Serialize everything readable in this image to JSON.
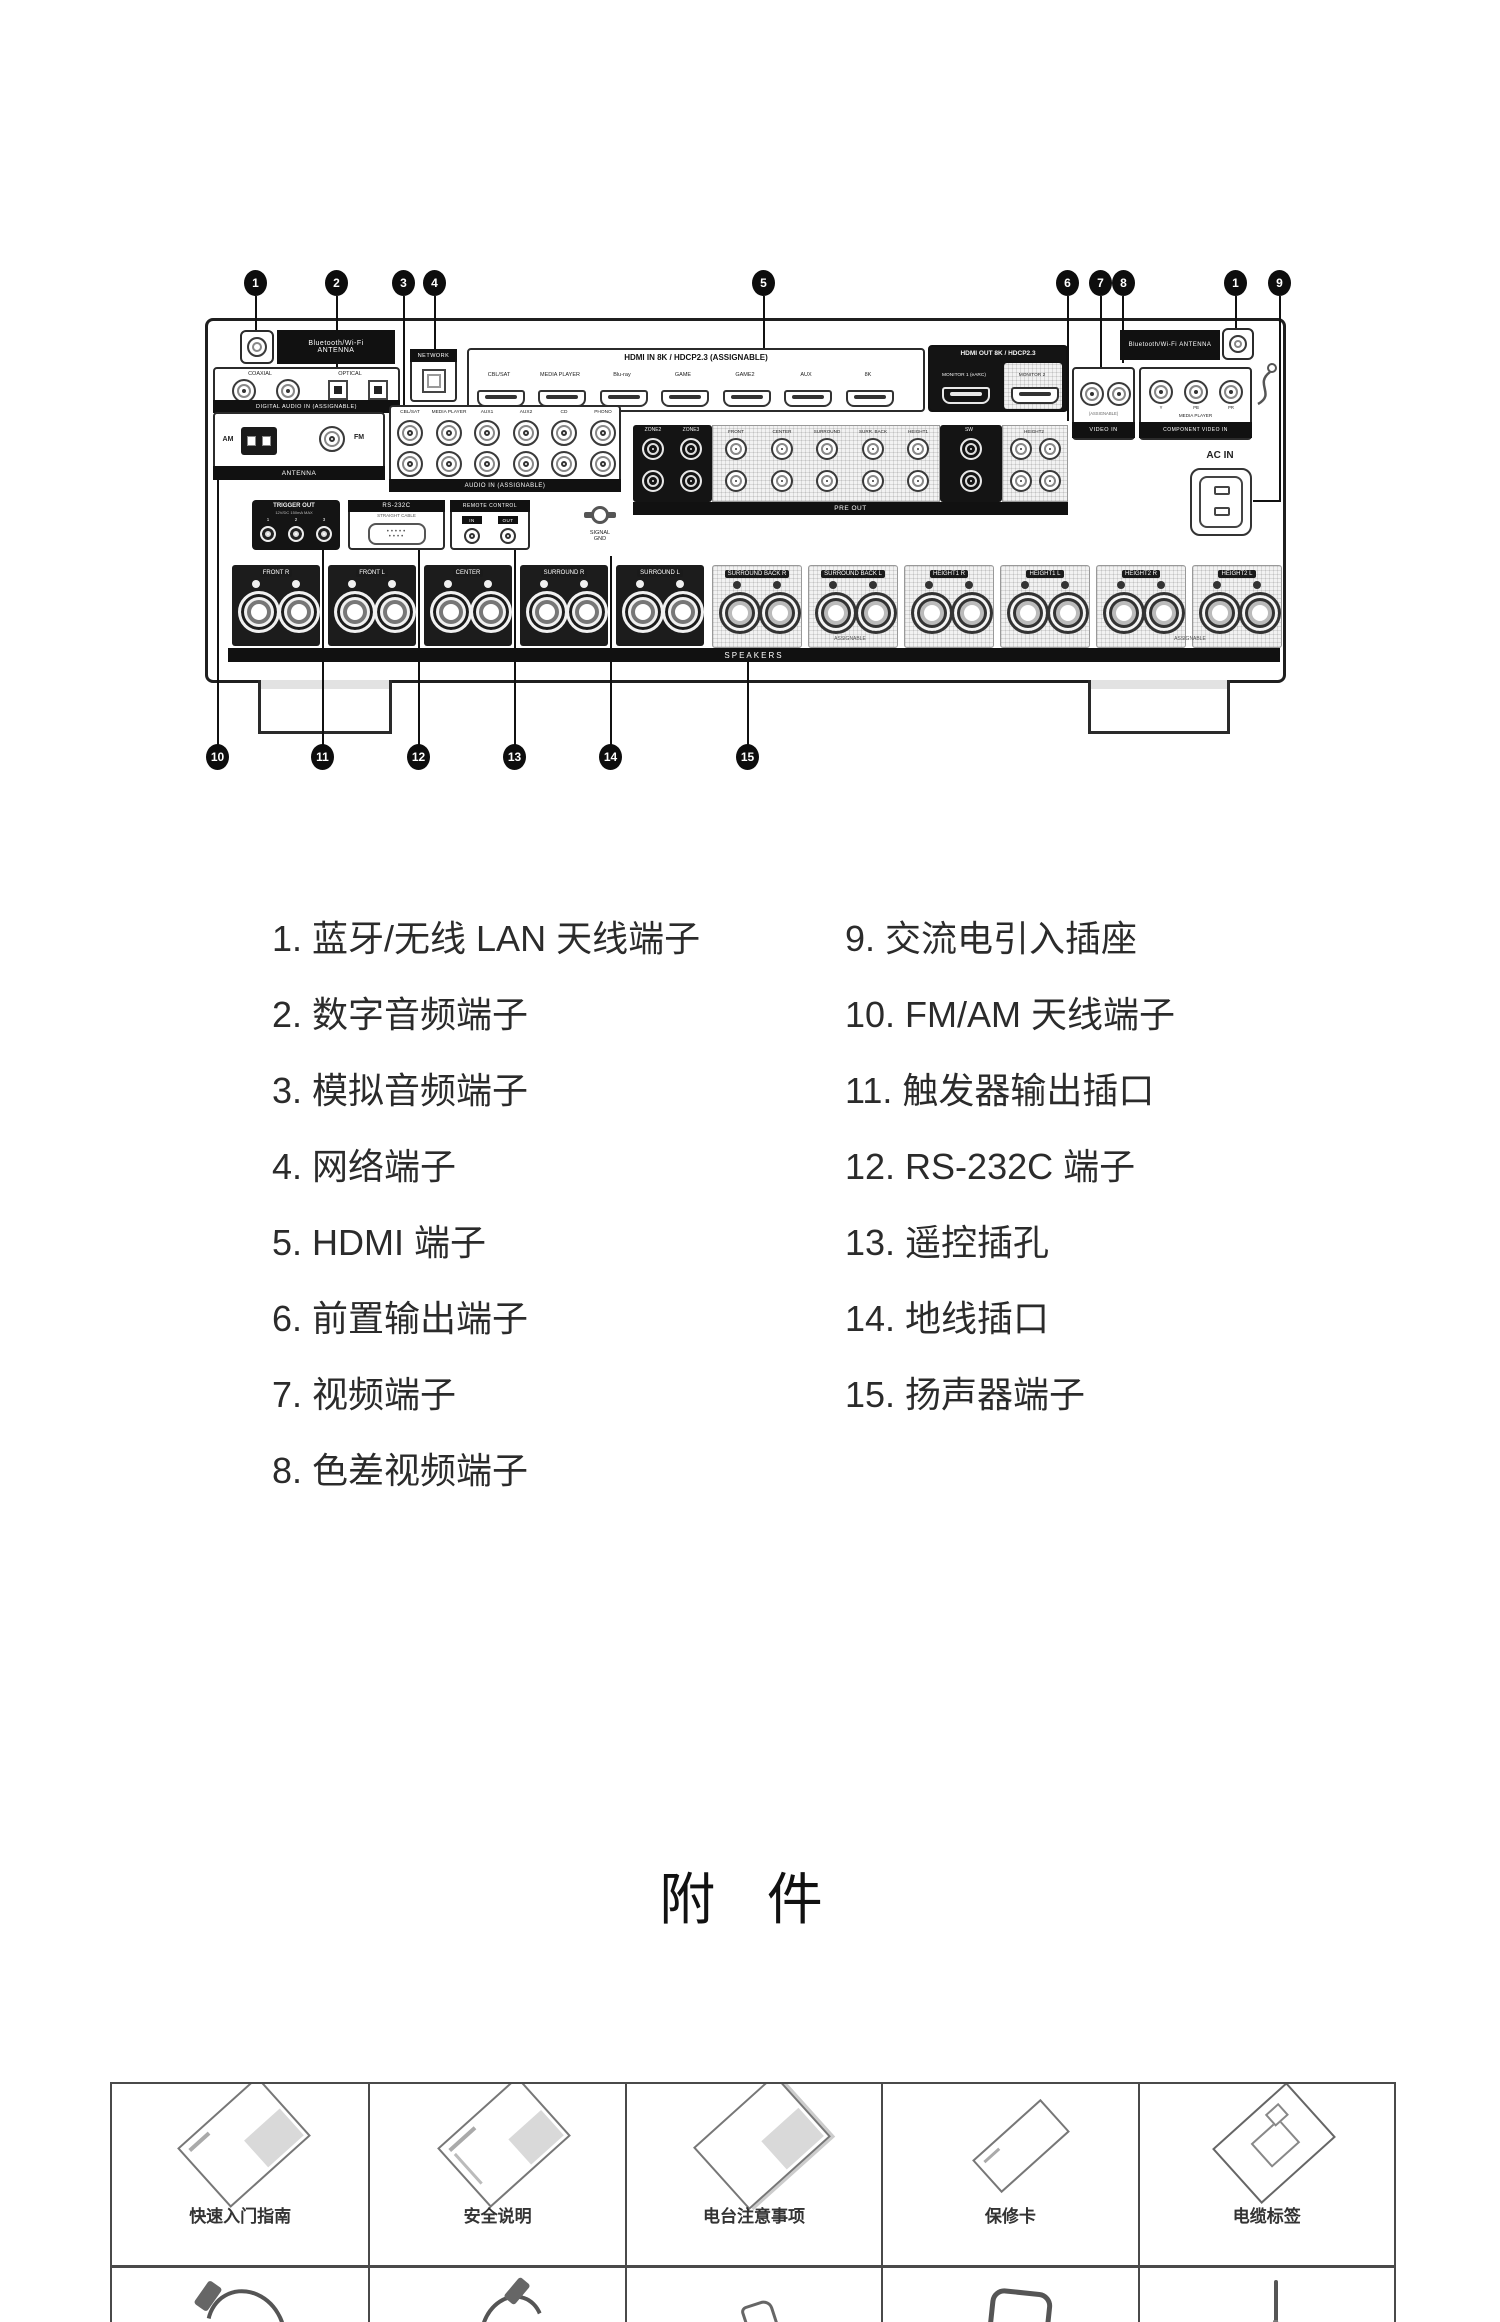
{
  "diagram": {
    "callouts_top": [
      {
        "n": "1"
      },
      {
        "n": "2"
      },
      {
        "n": "3"
      },
      {
        "n": "4"
      },
      {
        "n": "5"
      },
      {
        "n": "6"
      },
      {
        "n": "7"
      },
      {
        "n": "8"
      },
      {
        "n": "1"
      },
      {
        "n": "9"
      }
    ],
    "callouts_bottom": [
      {
        "n": "10"
      },
      {
        "n": "11"
      },
      {
        "n": "12"
      },
      {
        "n": "13"
      },
      {
        "n": "14"
      },
      {
        "n": "15"
      }
    ],
    "panel_labels": {
      "bt_antenna_line1": "Bluetooth/Wi-Fi",
      "bt_antenna_line2": "ANTENNA",
      "digital_audio_coaxial": "COAXIAL",
      "digital_audio_optical": "OPTICAL",
      "digital_audio_strip": "DIGITAL AUDIO IN (ASSIGNABLE)",
      "network": "NETWORK",
      "hdmi_in_header": "HDMI IN   8K / HDCP2.3  (ASSIGNABLE)",
      "hdmi_out_header": "HDMI OUT  8K / HDCP2.3",
      "hdmi_out_monitor1": "MONITOR 1 (eARC)",
      "hdmi_out_monitor2": "MONITOR 2",
      "hdmi_inputs": [
        "CBL/SAT",
        "MEDIA PLAYER",
        "Blu-ray",
        "GAME",
        "GAME2",
        "AUX",
        "8K"
      ],
      "antenna_am": "AM",
      "antenna_fm": "FM",
      "antenna_strip": "ANTENNA",
      "audio_columns": [
        "CBL/SAT",
        "MEDIA PLAYER",
        "AUX1",
        "AUX2",
        "CD",
        "PHONO"
      ],
      "audio_strip": "AUDIO IN (ASSIGNABLE)",
      "preout_zone2": "ZONE2",
      "preout_zone3": "ZONE3",
      "preout_columns": [
        "FRONT",
        "CENTER",
        "SURROUND",
        "SURR. BACK",
        "HEIGHT1"
      ],
      "preout_sw": "SW",
      "preout_height2": "HEIGHT2",
      "preout_strip": "PRE OUT",
      "trigger_header": "TRIGGER OUT",
      "trigger_sub": "12V/DC 150mA MAX",
      "trigger_jacks": [
        "1",
        "2",
        "3"
      ],
      "rs232c_header": "RS-232C",
      "rs232c_sub": "STRAIGHT CABLE",
      "remote_header": "REMOTE CONTROL",
      "remote_in": "IN",
      "remote_out": "OUT",
      "signal_gnd_line1": "SIGNAL",
      "signal_gnd_line2": "GND",
      "video_strip": "VIDEO IN",
      "component_cols": [
        "Y",
        "PB",
        "PR"
      ],
      "component_media": "MEDIA PLAYER",
      "component_strip": "COMPONENT VIDEO IN",
      "assignable_note": "(ASSIGNABLE)",
      "ac_in": "AC IN",
      "speakers_strip": "SPEAKERS",
      "assignable": "ASSIGNABLE",
      "speaker_channels": [
        "FRONT R",
        "FRONT L",
        "CENTER",
        "SURROUND R",
        "SURROUND L",
        "SURROUND BACK R",
        "SURROUND BACK L",
        "HEIGHT1 R",
        "HEIGHT1 L",
        "HEIGHT2 R",
        "HEIGHT2 L"
      ]
    }
  },
  "legend": {
    "items_left": [
      "1. 蓝牙/无线 LAN 天线端子",
      "2. 数字音频端子",
      "3. 模拟音频端子",
      "4. 网络端子",
      "5. HDMI 端子",
      "6. 前置输出端子",
      "7. 视频端子",
      "8. 色差视频端子"
    ],
    "items_right": [
      "9. 交流电引入插座",
      "10. FM/AM 天线端子",
      "11. 触发器输出插口",
      "12. RS-232C 端子",
      "13. 遥控插孔",
      "14. 地线插口",
      "15. 扬声器端子"
    ]
  },
  "accessories_section": {
    "title": "附 件",
    "row1": [
      "快速入门指南",
      "安全说明",
      "电台注意事项",
      "保修卡",
      "电缆标签"
    ]
  }
}
